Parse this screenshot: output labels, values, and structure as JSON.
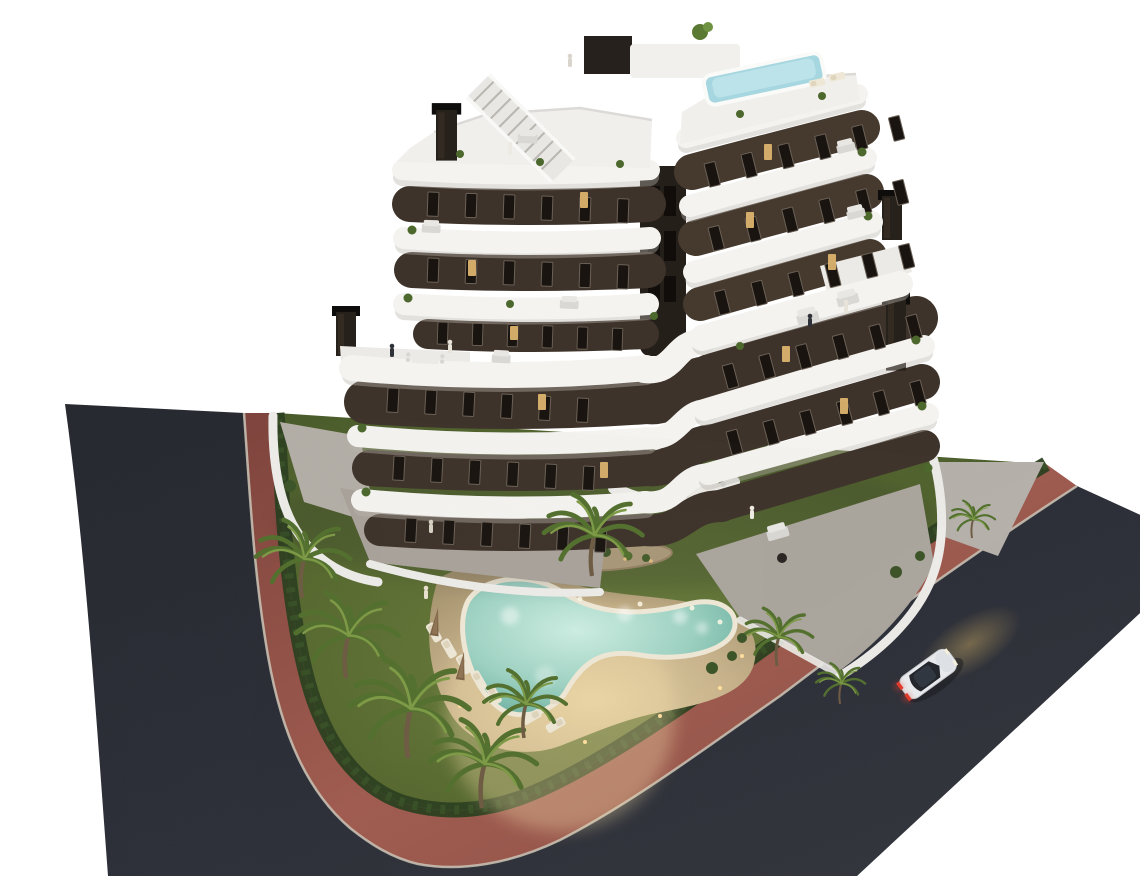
{
  "scene": {
    "description": "Aerial dusk 3D architectural rendering of a modern chevron-shaped apartment building with dark brown facades and curved white balcony bands, rooftop terraces with a small pool and staircase, a landscaped garden with a free-form glowing swimming pool, sun loungers, folded parasols, palm trees and hedges, surrounded by a red paved sidewalk and dark asphalt streets with one white car driving past",
    "view": "high three-quarter aerial view",
    "time_of_day": "dusk",
    "objects": [
      "apartment-building",
      "white-balcony-bands",
      "dark-brown-facade",
      "rooftop-terrace",
      "rooftop-pool",
      "rooftop-staircase",
      "chimneys",
      "swimming-pool",
      "pool-deck",
      "sun-loungers",
      "parasols",
      "palm-trees",
      "lawn",
      "hedges",
      "planter-island",
      "perimeter-walls",
      "ground-floor-terraces",
      "dining-tables",
      "sofas",
      "people",
      "red-sidewalk",
      "asphalt-streets",
      "white-car"
    ],
    "counts": {
      "left_wing_floors": 6,
      "right_wing_floors": 7,
      "rooftop_pools": 1,
      "ground_pools": 1,
      "parasols": 2,
      "sun_loungers": 7,
      "palm_trees_approx": 9,
      "cars": 1,
      "people_visible_approx": 12
    }
  },
  "colors": {
    "background": "#ffffff",
    "asphalt": "#2a2d36",
    "sidewalk_red": "#94564c",
    "curb": "#c6beb0",
    "grass": "#55682f",
    "hedge": "#2c4020",
    "palm_green": "#6b8a3a",
    "deck_sand": "#c9b691",
    "pool_water": "#8fcabb",
    "pool_water_light": "#cdeee2",
    "pool_rim": "#efe8d6",
    "facade_brown": "#3e332a",
    "band_white": "#f4f3f0",
    "window_dark": "#191410",
    "window_lit": "#dcb36e",
    "rooftop_pool_blue": "#a6d7e0",
    "car_body": "#e9ebee",
    "car_taillight": "#e03a2c",
    "headlight_glow": "#7a6a4a"
  }
}
